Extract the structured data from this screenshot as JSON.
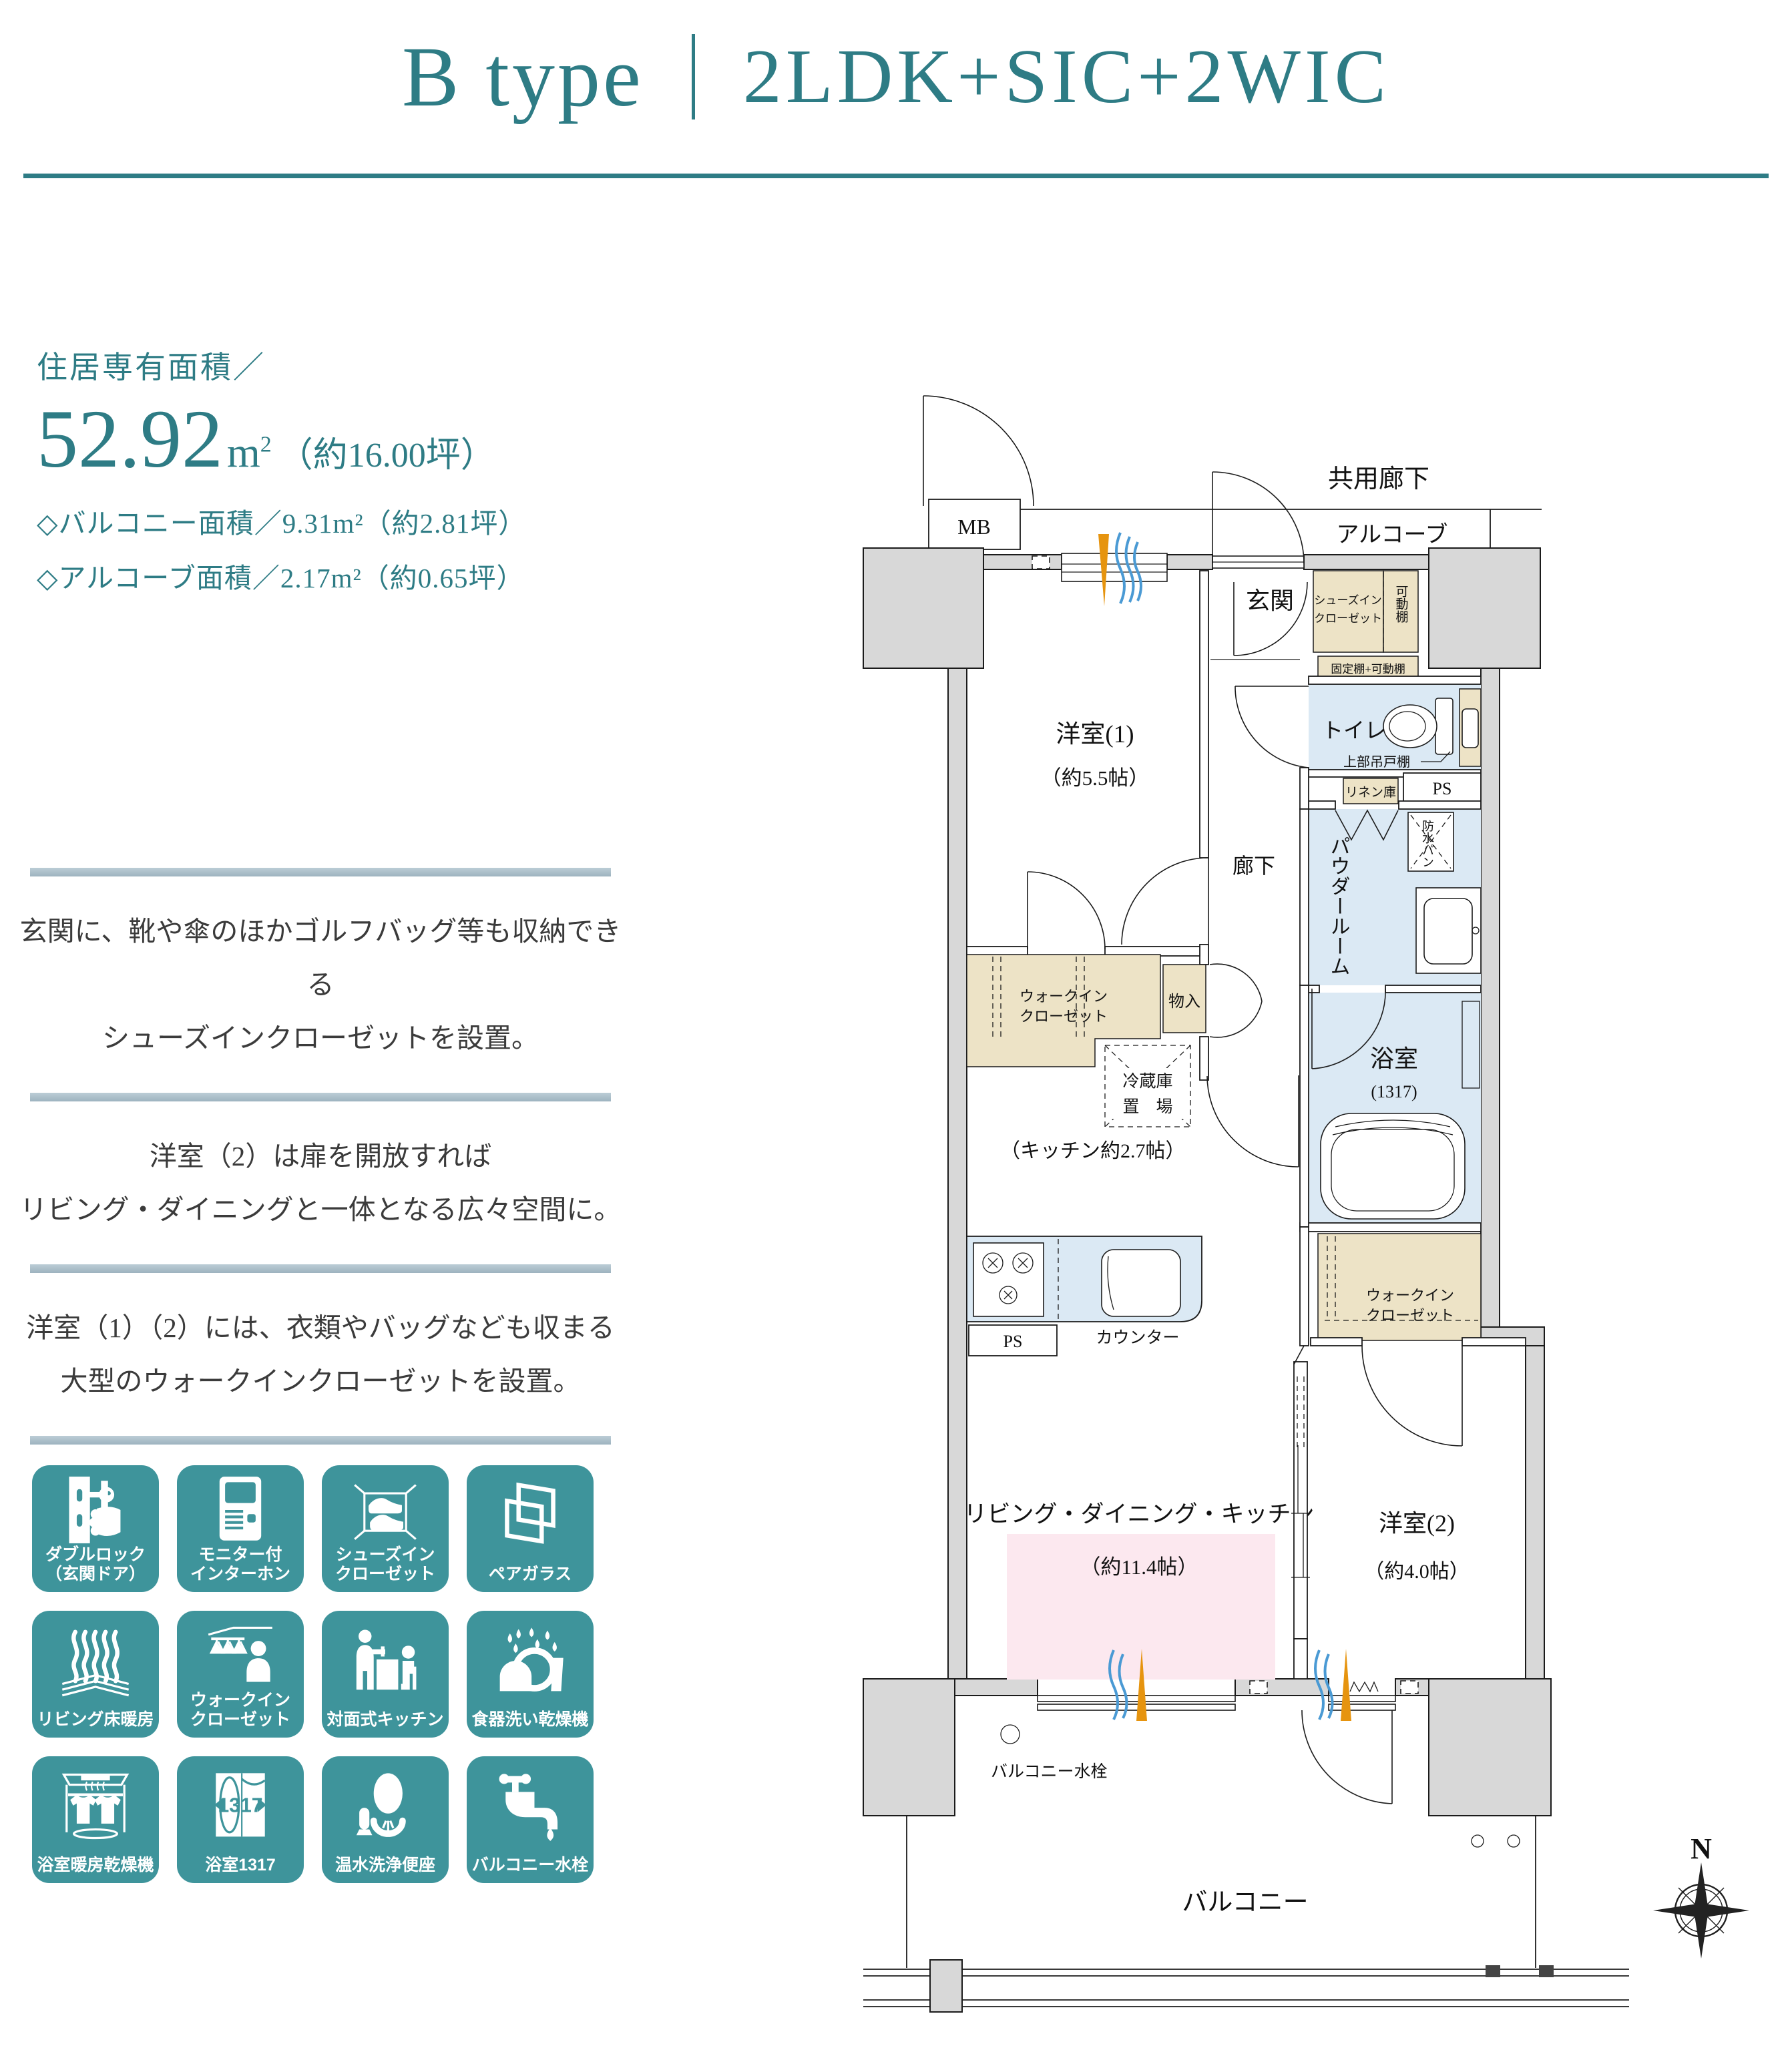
{
  "colors": {
    "accent_teal": "#2e7c85",
    "tile_teal": "#3e949b",
    "divider_blue": "#9db3bf",
    "closet_beige": "#ede3c6",
    "wet_blue": "#dbe9f4",
    "ldk_pink": "#fce8ef",
    "wall_gray": "#d8d8d8",
    "arrow_orange": "#e6940f",
    "wave_blue": "#4a9ad4"
  },
  "header": {
    "type_label": "B type",
    "plan_label": "2LDK+SIC+2WIC"
  },
  "area": {
    "heading": "住居専有面積／",
    "value": "52.92",
    "unit": "m",
    "unit_sup": "2",
    "tsubo": "（約16.00坪）",
    "balcony_line": "◇バルコニー面積／9.31m²（約2.81坪）",
    "alcove_line": "◇アルコーブ面積／2.17m²（約0.65坪）"
  },
  "features": {
    "blocks": [
      {
        "line1": "玄関に、靴や傘のほかゴルフバッグ等も収納できる",
        "line2": "シューズインクローゼットを設置。"
      },
      {
        "line1": "洋室（2）は扉を開放すれば",
        "line2": "リビング・ダイニングと一体となる広々空間に。"
      },
      {
        "line1": "洋室（1）（2）には、衣類やバッグなども収まる",
        "line2": "大型のウォークインクローゼットを設置。"
      }
    ]
  },
  "amenities": {
    "items": [
      {
        "line1": "ダブルロック",
        "line2": "（玄関ドア）"
      },
      {
        "line1": "モニター付",
        "line2": "インターホン"
      },
      {
        "line1": "シューズイン",
        "line2": "クローゼット"
      },
      {
        "line1": "ペアガラス",
        "line2": ""
      },
      {
        "line1": "リビング床暖房",
        "line2": ""
      },
      {
        "line1": "ウォークイン",
        "line2": "クローゼット"
      },
      {
        "line1": "対面式キッチン",
        "line2": ""
      },
      {
        "line1": "食器洗い乾燥機",
        "line2": ""
      },
      {
        "line1": "浴室暖房乾燥機",
        "line2": ""
      },
      {
        "line1": "浴室1317",
        "line2": "",
        "icon_text": "1317"
      },
      {
        "line1": "温水洗浄便座",
        "line2": ""
      },
      {
        "line1": "バルコニー水栓",
        "line2": ""
      }
    ]
  },
  "plan": {
    "kyoyo_roka": "共用廊下",
    "alcove": "アルコーブ",
    "mb": "MB",
    "genkan": "玄関",
    "sic_l1": "シューズイン",
    "sic_l2": "クローゼット",
    "kadodana": "可動棚",
    "koteidana": "固定棚+可動棚",
    "toilet": "トイレ",
    "jobu_tsuridana": "上部吊戸棚",
    "linen": "リネン庫",
    "ps1": "PS",
    "powder": "パウダールーム",
    "bousui_pan": "防水パン",
    "yoshitsu1": "洋室(1)",
    "yoshitsu1_size": "（約5.5帖）",
    "roka": "廊下",
    "wic1_l1": "ウォークイン",
    "wic1_l2": "クローゼット",
    "monoire": "物入",
    "reizoko_l1": "冷蔵庫",
    "reizoko_l2": "置　場",
    "kitchen_size": "（キッチン約2.7帖）",
    "bath": "浴室",
    "bath_size": "(1317)",
    "wic2_l1": "ウォークイン",
    "wic2_l2": "クローゼット",
    "counter": "カウンター",
    "ps2": "PS",
    "ldk": "リビング・ダイニング・キッチン",
    "ldk_size": "（約11.4帖）",
    "yoshitsu2": "洋室(2)",
    "yoshitsu2_size": "（約4.0帖）",
    "balcony_faucet": "バルコニー水栓",
    "balcony": "バルコニー",
    "compass_n": "N"
  }
}
